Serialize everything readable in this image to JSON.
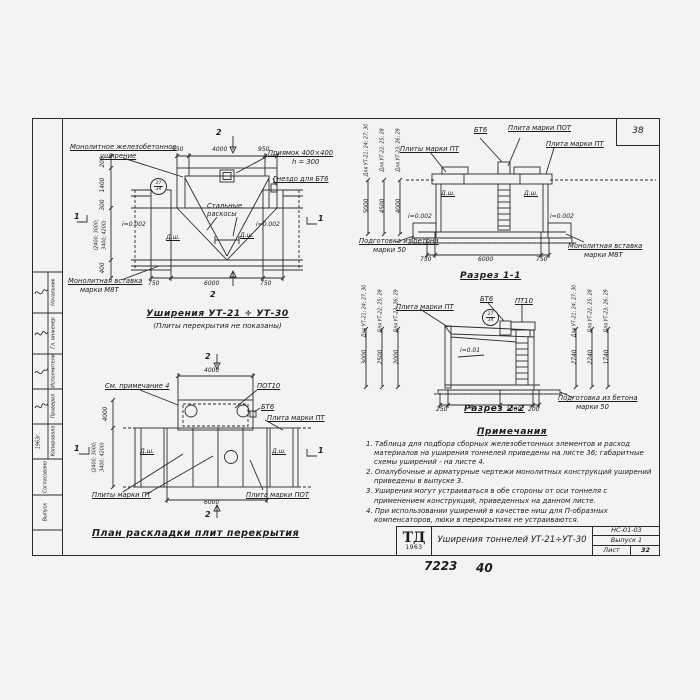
{
  "sheet": {
    "page_number": "38",
    "footer_code": "7223",
    "footer_page": "40"
  },
  "titleblock": {
    "logo": "ТД",
    "logo_year": "1963",
    "title": "Уширения тоннелей УТ-21÷УТ-30",
    "code": "НС-01-03",
    "issue": "Выпуск 1",
    "sheet_label": "Лист",
    "sheet_number": "32"
  },
  "stamp": {
    "role_1": "Начальник",
    "role_2": "Гл. инженер",
    "role_3": "Исполнители",
    "role_4": "Проверил",
    "role_5": "Копировала",
    "year": "1963г.",
    "bottom_1": "Согласовано",
    "bottom_2": "Выпуск"
  },
  "common": {
    "bt6": "БТ6",
    "pt10": "ПТ10",
    "pot10": "ПОТ10",
    "plate_pt": "Плита марки ПТ",
    "plates_pt": "Плиты марки ПТ",
    "plate_pot": "Плита марки ПОТ",
    "dsh": "Д.ш.",
    "slope_002": "i=0.002",
    "slope_001": "i=0.01",
    "prep_1": "Подготовка из бетона",
    "prep_2": "марки 50",
    "insert_1": "Монолитная вставка",
    "insert_2": "марки М8Т",
    "mark_num": "27",
    "mark_den": "34",
    "for_a": "Для УТ-21; 24; 27; 30",
    "for_b": "Для УТ-22; 25; 28",
    "for_c": "Для УТ-23; 26; 29",
    "sec_1": "1",
    "sec_2": "2"
  },
  "plan_top": {
    "label_widening_1": "Монолитное железобетонное",
    "label_widening_2": "уширение",
    "label_pit_1": "Приямок 400×400",
    "label_pit_2": "h = 300",
    "label_socket": "Гнездо для БТ6",
    "label_braces_1": "Стальные",
    "label_braces_2": "раскосы",
    "dim_top_left": "950",
    "dim_top_mid": "4000",
    "dim_top_right": "950",
    "dim_bot_left": "750",
    "dim_bot_mid": "6000",
    "dim_bot_right": "750",
    "dim_l1": "200",
    "dim_l2": "1400",
    "dim_l3": "300",
    "dim_l4a": "(2400; 3000;",
    "dim_l4b": "3400; 4200)",
    "dim_l5": "400",
    "title": "Уширения УТ-21 ÷ УТ-30",
    "subtitle": "(Плиты перекрытия не показаны)"
  },
  "section1": {
    "title": "Разрез 1-1",
    "dim_left": "750",
    "dim_mid": "6000",
    "dim_right": "750",
    "h1": "5000",
    "h2": "4500",
    "h3": "4000"
  },
  "section2": {
    "title": "Разрез 2-2",
    "dim_1": "250",
    "dim_2": "А",
    "dim_3": "1000",
    "dim_4": "200",
    "hl1": "3000",
    "hl2": "2500",
    "hl3": "2000",
    "hr1": "2740",
    "hr2": "2240",
    "hr3": "1740"
  },
  "plan_bottom": {
    "title": "План раскладки плит перекрытия",
    "note_ref": "См. примечание 4",
    "dim_top": "4000",
    "dim_bot": "6000",
    "dim_left_top": "4000",
    "dim_left_a": "(2400; 3000;",
    "dim_left_b": "3400; 4200)"
  },
  "notes": {
    "heading": "Примечания",
    "items": [
      "1. Таблица для подбора сборных железобетонных элементов и расход материалов на уширения тоннелей приведены на листе 36; габаритные схемы уширений - на листе 4.",
      "2. Опалубочные и арматурные чертежи монолитных конструкций уширений приведены в выпуске 3.",
      "3. Уширения могут устраиваться в обе стороны от оси тоннеля с применением конструкций, приведенных на данном листе.",
      "4. При использовании уширений в качестве ниш для П-образных компенсаторов, люки в перекрытиях не устраиваются."
    ]
  }
}
